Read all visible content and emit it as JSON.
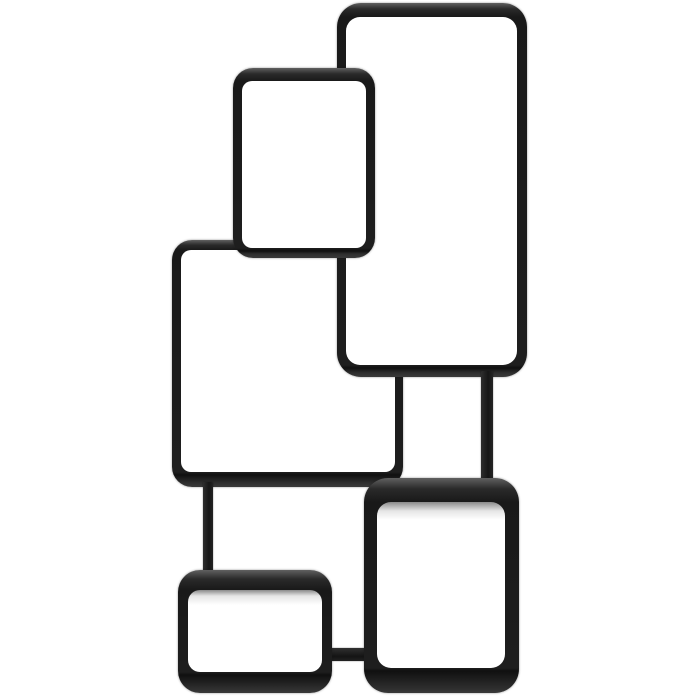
{
  "scene": {
    "type": "product-photograph",
    "subject": "Modular wall shelf of five interlocking rounded rectangle cube frames",
    "finish": "matte black metal",
    "background_color": "#ffffff",
    "frame_color": "#1e1e1e",
    "frame_highlight": "#606060",
    "frame_shadow": "#101010",
    "opening_color": "#ffffff"
  },
  "modules": [
    {
      "name": "cube-shelf-square-middle-left",
      "z": 1,
      "x": 172,
      "y": 240,
      "w": 231,
      "h": 247,
      "bt": 10,
      "br": 8,
      "bb": 15,
      "bl": 9,
      "r": 20,
      "fade": 0
    },
    {
      "name": "cube-shelf-tall-top-right",
      "z": 2,
      "x": 337,
      "y": 3,
      "w": 190,
      "h": 374,
      "bt": 14,
      "br": 10,
      "bb": 12,
      "bl": 9,
      "r": 24,
      "fade": 0
    },
    {
      "name": "cube-shelf-portrait-top-center",
      "z": 3,
      "x": 233,
      "y": 68,
      "w": 142,
      "h": 190,
      "bt": 13,
      "br": 9,
      "bb": 10,
      "bl": 9,
      "r": 20,
      "fade": 0
    },
    {
      "name": "cube-shelf-rect-bottom-right",
      "z": 5,
      "x": 364,
      "y": 478,
      "w": 155,
      "h": 215,
      "bt": 24,
      "br": 14,
      "bb": 25,
      "bl": 13,
      "r": 24,
      "fade": 9
    },
    {
      "name": "cube-shelf-small-bottom-left",
      "z": 6,
      "x": 178,
      "y": 570,
      "w": 154,
      "h": 123,
      "bt": 20,
      "br": 10,
      "bb": 21,
      "bl": 10,
      "r": 22,
      "fade": 6
    }
  ],
  "connectors": [
    {
      "name": "connector-tall-to-bottom-right-shelf",
      "z": 4,
      "x": 481,
      "y": 371,
      "w": 12,
      "h": 111,
      "orientation": "vertical"
    },
    {
      "name": "connector-square-to-small-shelf",
      "z": 4,
      "x": 203,
      "y": 482,
      "w": 10,
      "h": 92,
      "orientation": "vertical"
    },
    {
      "name": "connector-small-to-bottom-right-shelf",
      "z": 4,
      "x": 330,
      "y": 648,
      "w": 36,
      "h": 13,
      "orientation": "horizontal"
    }
  ],
  "caption": "Black interlocking cube wall shelf on white background"
}
